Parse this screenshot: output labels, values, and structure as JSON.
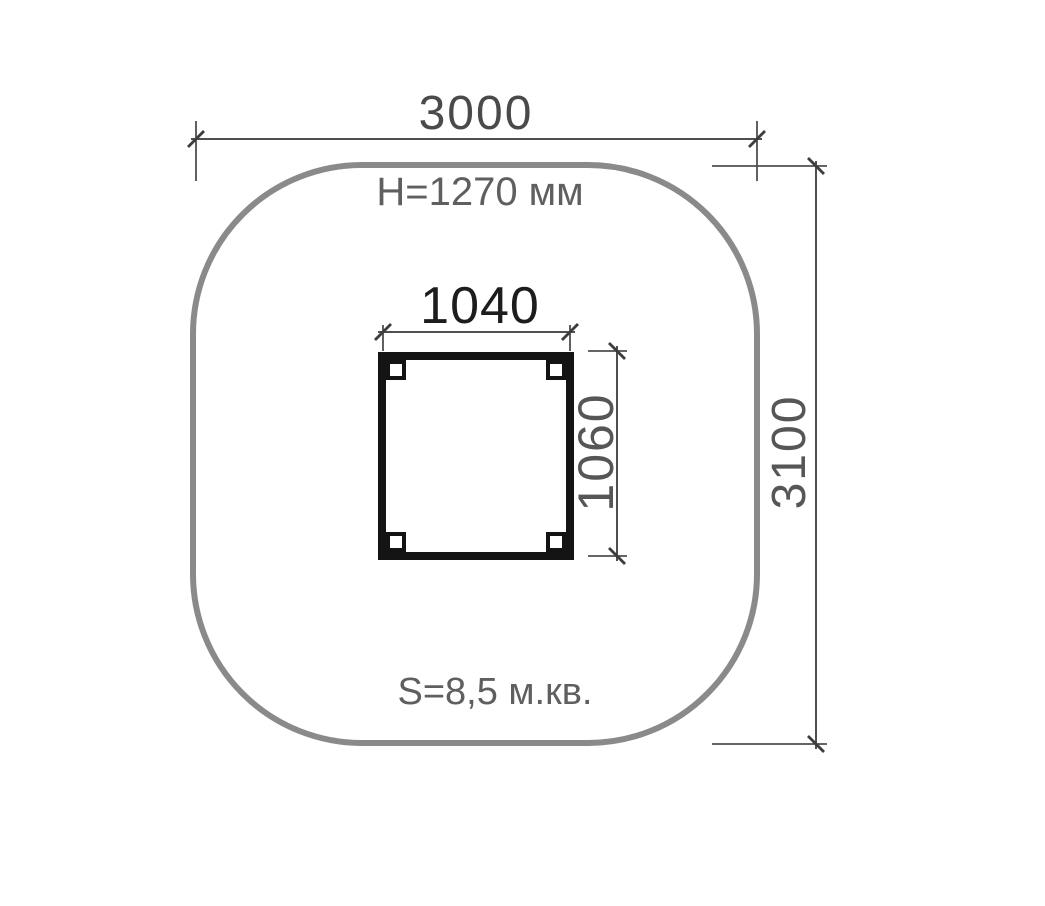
{
  "labels": {
    "outer_width": "3000",
    "outer_height": "3100",
    "equipment_height": "H=1270 мм",
    "inner_width": "1040",
    "inner_height": "1060",
    "area": "S=8,5 м.кв."
  },
  "colors": {
    "background": "#ffffff",
    "zone_outline": "#8a8a8a",
    "structure_outline": "#141414",
    "dimension_line": "#4f4f4f",
    "tick": "#3d3d3d",
    "label_dark": "#1d1d1d",
    "label_medium": "#4a4a4a",
    "label_gray": "#5f5f5f",
    "label_rotated": "#565656"
  }
}
